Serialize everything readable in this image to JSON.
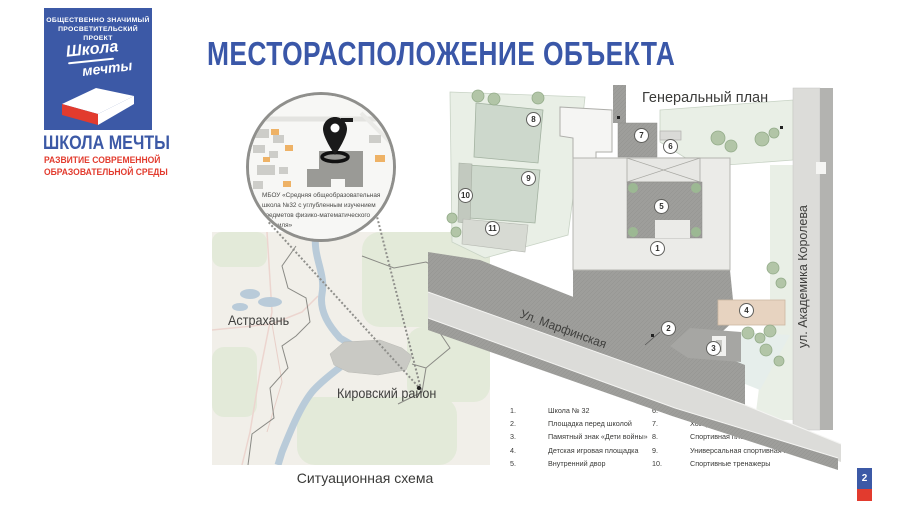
{
  "brand": {
    "project_line1": "ОБЩЕСТВЕННО ЗНАЧИМЫЙ",
    "project_line2": "ПРОСВЕТИТЕЛЬСКИЙ ПРОЕКТ",
    "logo_script_line1": "Школа",
    "logo_script_line2": "мечты",
    "title": "ШКОЛА МЕЧТЫ",
    "subtitle_line1": "РАЗВИТИЕ СОВРЕМЕННОЙ",
    "subtitle_line2": "ОБРАЗОВАТЕЛЬНОЙ СРЕДЫ",
    "color_blue": "#3c59a6",
    "color_red": "#e23b2e"
  },
  "header": {
    "title": "МЕСТОРАСПОЛОЖЕНИЕ ОБЪЕКТА"
  },
  "callout": {
    "text": "МБОУ «Средняя общеобразовательная школа №32 с углубленным изучением предметов физико-математического профиля»"
  },
  "situation_map": {
    "city": "Астрахань",
    "district": "Кировский район",
    "caption": "Ситуационная схема"
  },
  "plan": {
    "title": "Генеральный план",
    "street_marfinskaya": "Ул. Марфинская",
    "street_koroleva": "ул. Академика Королева",
    "markers": [
      "1",
      "2",
      "3",
      "4",
      "5",
      "6",
      "7",
      "8",
      "9",
      "10",
      "11"
    ]
  },
  "legend": {
    "left": [
      {
        "num": "1.",
        "label": "Школа № 32"
      },
      {
        "num": "2.",
        "label": "Площадка перед школой"
      },
      {
        "num": "3.",
        "label": "Памятный знак «Дети войны»"
      },
      {
        "num": "4.",
        "label": "Детская игровая площадка"
      },
      {
        "num": "5.",
        "label": "Внутренний двор"
      }
    ],
    "right": [
      {
        "num": "6.",
        "label": "Хоз. постройка"
      },
      {
        "num": "7.",
        "label": "Хоз. двор"
      },
      {
        "num": "8.",
        "label": "Спортивная площадка"
      },
      {
        "num": "9.",
        "label": "Универсальная спортивная площадка"
      },
      {
        "num": "10.",
        "label": "Спортивные тренажеры"
      }
    ]
  },
  "page": {
    "number": "2"
  }
}
